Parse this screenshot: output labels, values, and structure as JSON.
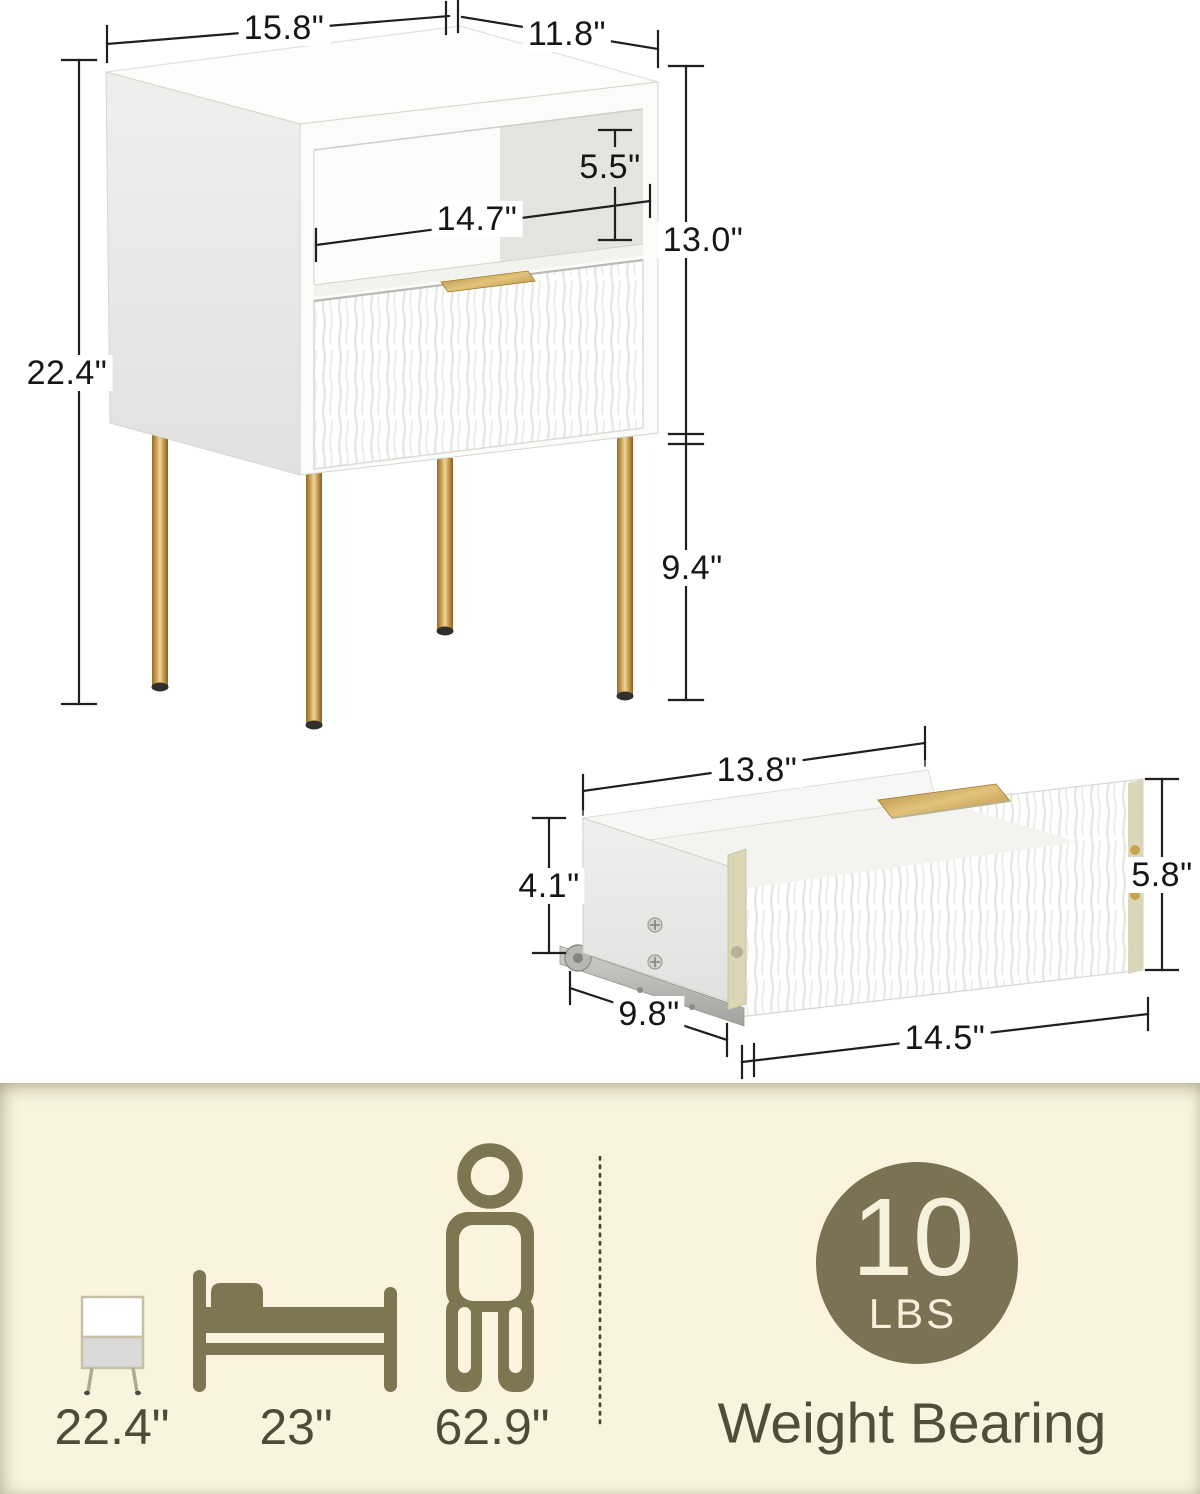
{
  "figure_main": {
    "dims": {
      "top_width": "15.8\"",
      "top_depth": "11.8\"",
      "opening_height": "5.5\"",
      "opening_width": "14.7\"",
      "cabinet_height": "13.0\"",
      "leg_height": "9.4\"",
      "overall_height": "22.4\""
    }
  },
  "figure_drawer": {
    "dims": {
      "inner_width": "13.8\"",
      "side_height": "4.1\"",
      "front_height": "5.8\"",
      "depth": "9.8\"",
      "front_width": "14.5\""
    }
  },
  "banner": {
    "comparisons": [
      {
        "icon": "nightstand-icon",
        "value": "22.4\""
      },
      {
        "icon": "bed-icon",
        "value": "23\""
      },
      {
        "icon": "person-icon",
        "value": "62.9\""
      }
    ],
    "weight_badge": {
      "value": "10",
      "unit": "LBS"
    },
    "weight_label": "Weight Bearing"
  },
  "palette": {
    "gold": "#c79e4e",
    "olive": "#7d7650",
    "banner_bg": "#faf4df",
    "dimension_ink": "#1f1f1f",
    "banner_ink": "#4e4c39"
  }
}
